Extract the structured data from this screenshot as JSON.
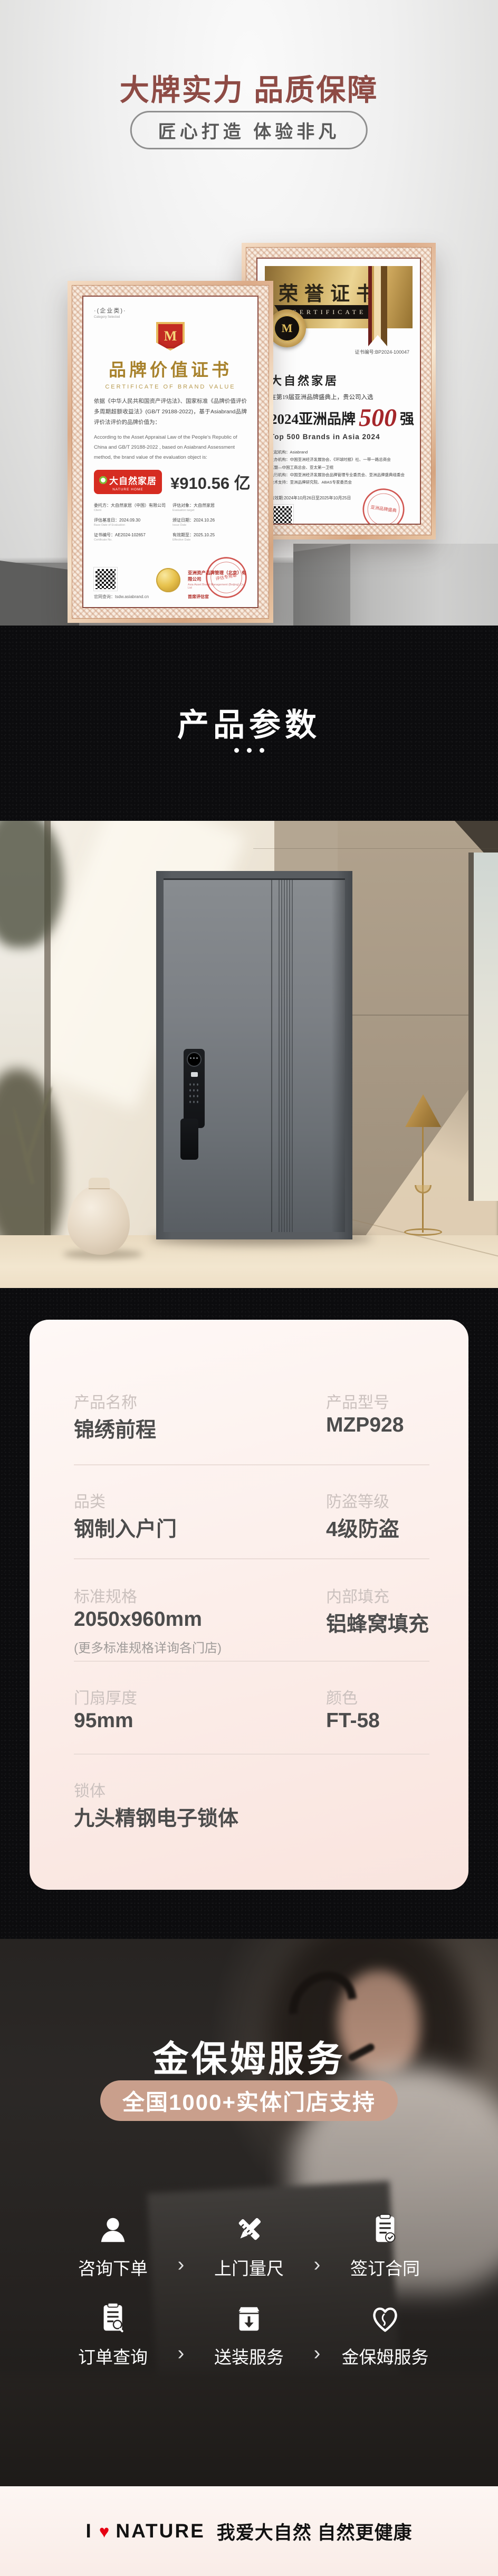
{
  "hero": {
    "title": "大牌实力 品质保障",
    "subtitle": "匠心打造 体验非凡"
  },
  "cert_left": {
    "category": "·(企业类)·",
    "category_en": "Category Selected",
    "emblem": "M",
    "title": "品牌价值证书",
    "title_en": "CERTIFICATE OF BRAND VALUE",
    "body_cn": "依据《中华人民共和国资产评估法》、国家标准《品牌价值评价多周期超额收益法》(GB/T 29188-2022)，基于Asiabrand品牌评价法评价的品牌价值为：",
    "body_en": "According to the Asset Appraisal Law of the People's Republic of China and GB/T 29188-2022 , based on Asiabrand Assessment method, the brand value of the evaluation object is:",
    "brand_logo": "大自然家居",
    "brand_logo_en": "NATURE HOME",
    "value": "¥910.56 亿",
    "fields": [
      {
        "label": "委托方：大自然家居（中国）有限公司",
        "sub": "Client"
      },
      {
        "label": "评估对象：大自然家居",
        "sub": "Evaluation target"
      },
      {
        "label": "评估基准日：2024.09.30",
        "sub": "Base Date of Evaluation"
      },
      {
        "label": "颁证日期：2024.10.26",
        "sub": "Issue Date"
      },
      {
        "label": "证书编号：AE2024-102657",
        "sub": "Certificate No."
      },
      {
        "label": "有效期至：2025.10.25",
        "sub": "Effective Date"
      }
    ],
    "issuer": "亚洲资产品牌管理（北京）有限公司",
    "issuer_sub": "Asia Asset Brand Management (Beijing) Co., Ltd",
    "signer": "首席评估官",
    "stamp_text": "评估专用章",
    "site": "官网查询：tsdw.asiabrand.cn"
  },
  "cert_right": {
    "title": "荣誉证书",
    "banner": "CERTIFICATE",
    "medal": "M",
    "cert_no": "证书编号:BP2024-100047",
    "brand": "大自然家居",
    "intro": "在第19届亚洲品牌盛典上，贵公司入选",
    "award_prefix": "2024亚洲品牌",
    "award_number": "500",
    "award_suffix": "强",
    "award_en": "Top 500 Brands in Asia 2024",
    "org_lines": [
      "发起机构：Asiabrand",
      "主办机构：中国亚洲经济发展协会、《环球时报》社、一带一路总商会",
      "东盟—中国工商总会、亚太第一卫视",
      "执行机构：中国亚洲经济发展协会品牌管理专业委员会、亚洲品牌盛典组委会",
      "技术支持：亚洲品牌研究院、ABAS专家委员会"
    ],
    "validity": "有效期:2024年10月26日至2025年10月25日",
    "stamp_text": "亚洲品牌盛典"
  },
  "params_band": {
    "title": "产品参数"
  },
  "param_card": {
    "rows": [
      {
        "label": "产品名称",
        "value": "锦绣前程"
      },
      {
        "label": "产品型号",
        "value": "MZP928"
      },
      {
        "label": "品类",
        "value": "钢制入户门"
      },
      {
        "label": "防盗等级",
        "value": "4级防盗"
      },
      {
        "label": "标准规格",
        "value": "2050x960mm",
        "note": "(更多标准规格详询各门店)"
      },
      {
        "label": "内部填充",
        "value": "铝蜂窝填充"
      },
      {
        "label": "门扇厚度",
        "value": "95mm"
      },
      {
        "label": "颜色",
        "value": "FT-58"
      },
      {
        "label": "锁体",
        "value": "九头精钢电子锁体"
      }
    ]
  },
  "service": {
    "title": "金保姆服务",
    "badge": "全国1000+实体门店支持",
    "chevron": "›",
    "steps1": [
      {
        "icon": "user-icon",
        "label": "咨询下单"
      },
      {
        "icon": "measure-icon",
        "label": "上门量尺"
      },
      {
        "icon": "contract-icon",
        "label": "签订合同"
      }
    ],
    "steps2": [
      {
        "icon": "order-search-icon",
        "label": "订单查询"
      },
      {
        "icon": "delivery-icon",
        "label": "送装服务"
      },
      {
        "icon": "care-icon",
        "label": "金保姆服务"
      }
    ]
  },
  "footer": {
    "logo_i": "I",
    "heart": "♥",
    "logo_nature": "NATURE",
    "tagline": "我爱大自然 自然更健康"
  },
  "colors": {
    "accent_red": "#8e4b45",
    "badge_salmon": "#c99f8c",
    "brand_red": "#d62c21",
    "heart_red": "#e60012",
    "gold": "#a8822c"
  }
}
